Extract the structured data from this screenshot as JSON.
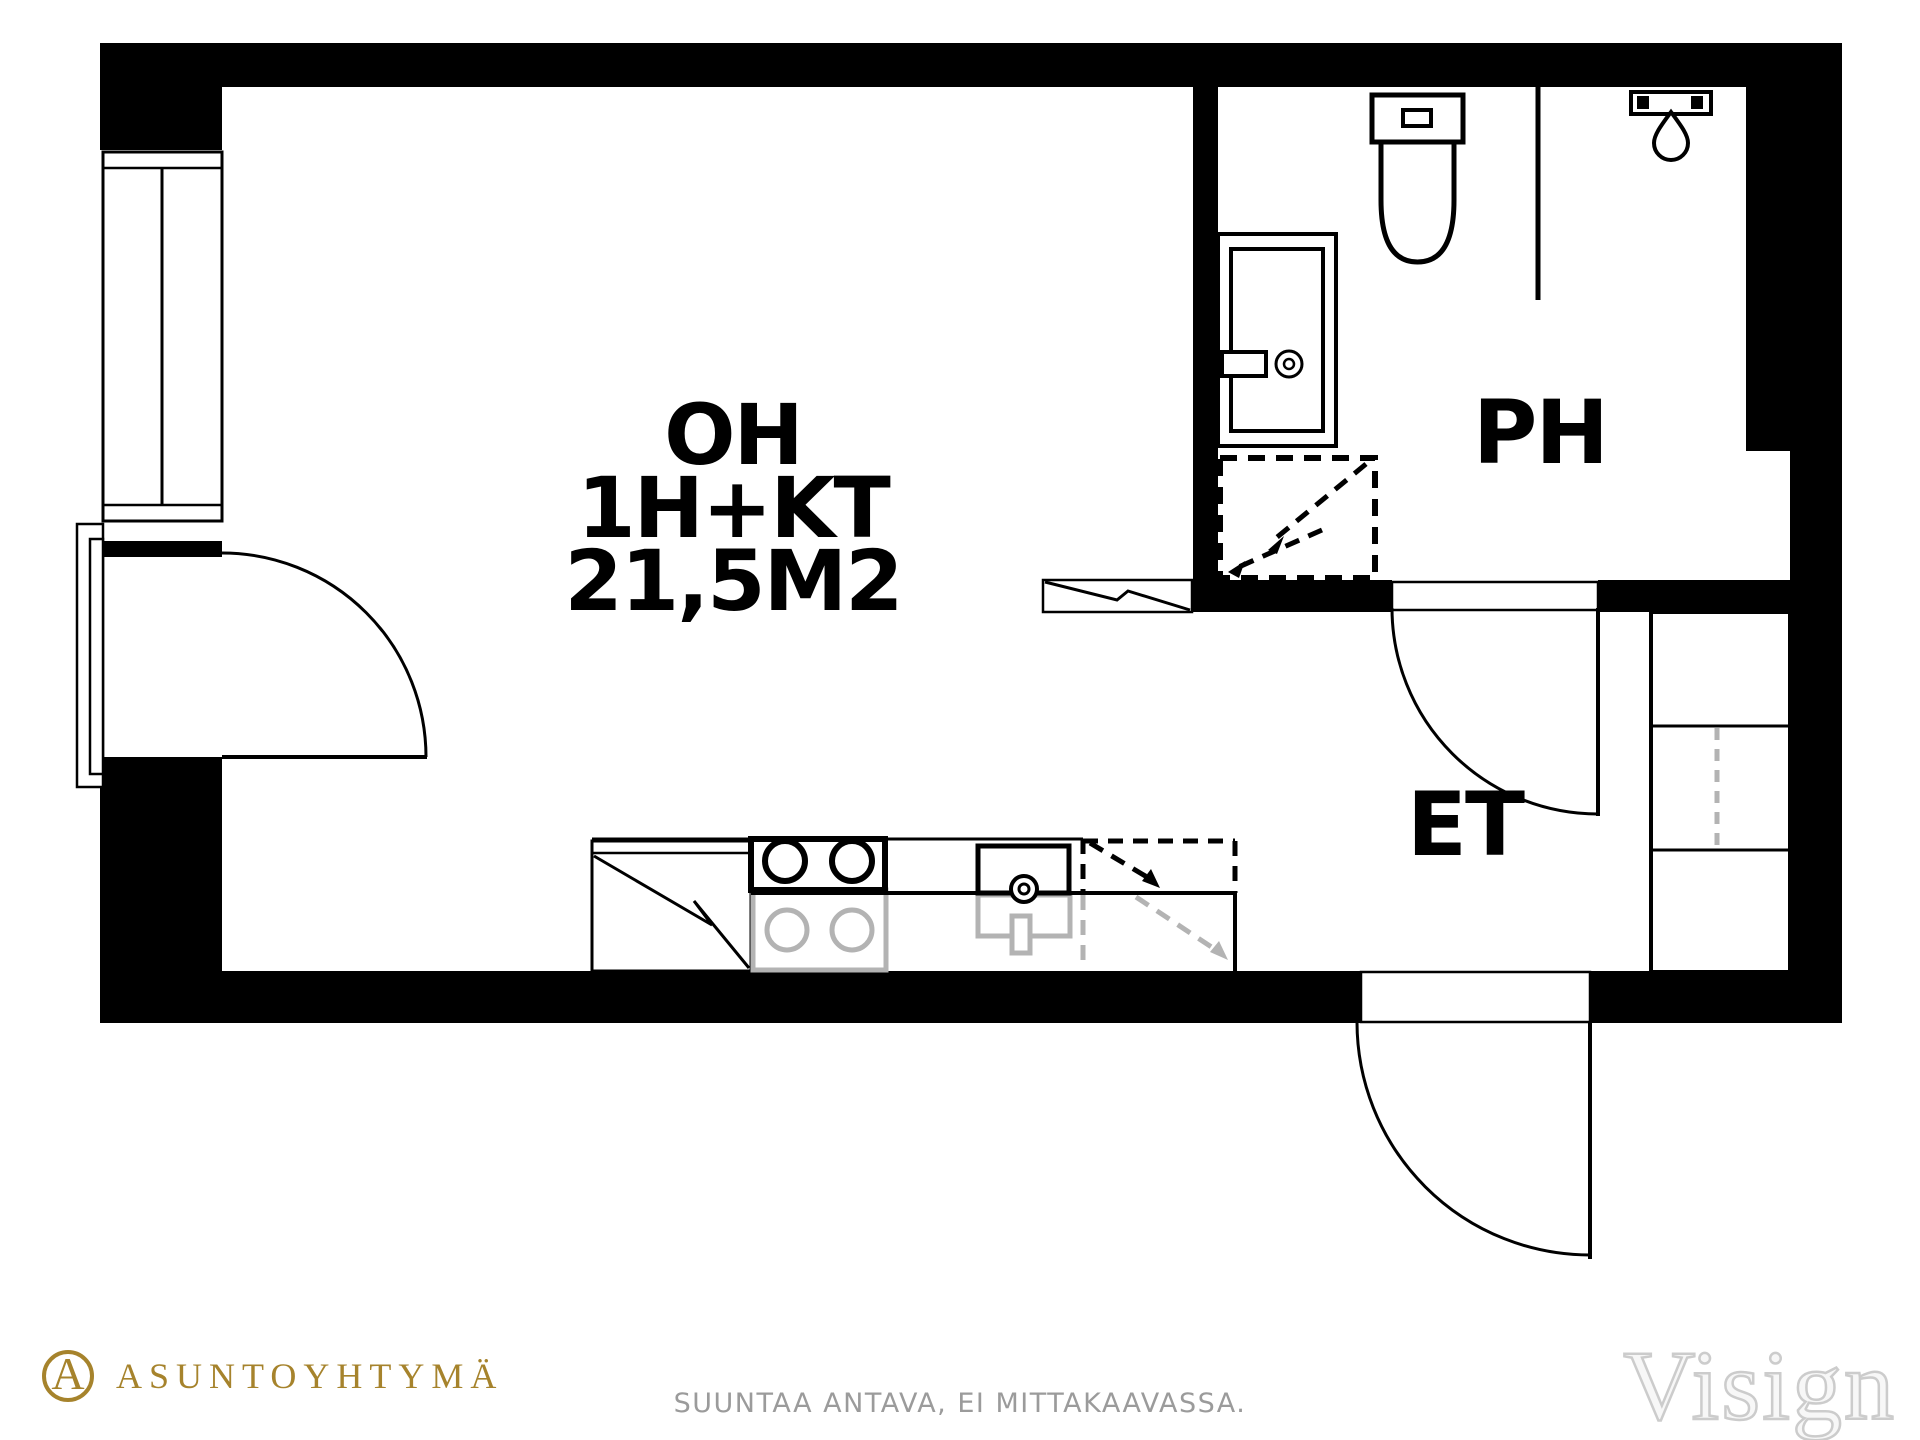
{
  "colors": {
    "ink": "#000000",
    "fixture-gray": "#b3b3b3",
    "brand-gold": "#a6832c",
    "muted-gray": "#9b9b9b",
    "watermark-fill": "#f7f7f7",
    "watermark-edge": "#cccccc",
    "paper": "#ffffff"
  },
  "plan": {
    "rooms": {
      "living": {
        "name": "OH",
        "layout": "1H+KT",
        "area": "21,5M2"
      },
      "bathroom": {
        "label": "PH"
      },
      "entry": {
        "label": "ET"
      }
    },
    "fixtures": [
      "window",
      "balcony-door",
      "toilet",
      "bathroom-sink",
      "shower-glass",
      "shower-head",
      "washing-machine-reservation",
      "wardrobe",
      "fridge",
      "stove",
      "kitchen-sink",
      "dishwasher-reservation",
      "entrance-door",
      "bathroom-door"
    ]
  },
  "footer": {
    "brand": {
      "monogram": "A",
      "name": "ASUNTOYHTYMÄ"
    },
    "disclaimer": "SUUNTAA ANTAVA, EI MITTAKAAVASSA.",
    "watermark": "Visign"
  }
}
